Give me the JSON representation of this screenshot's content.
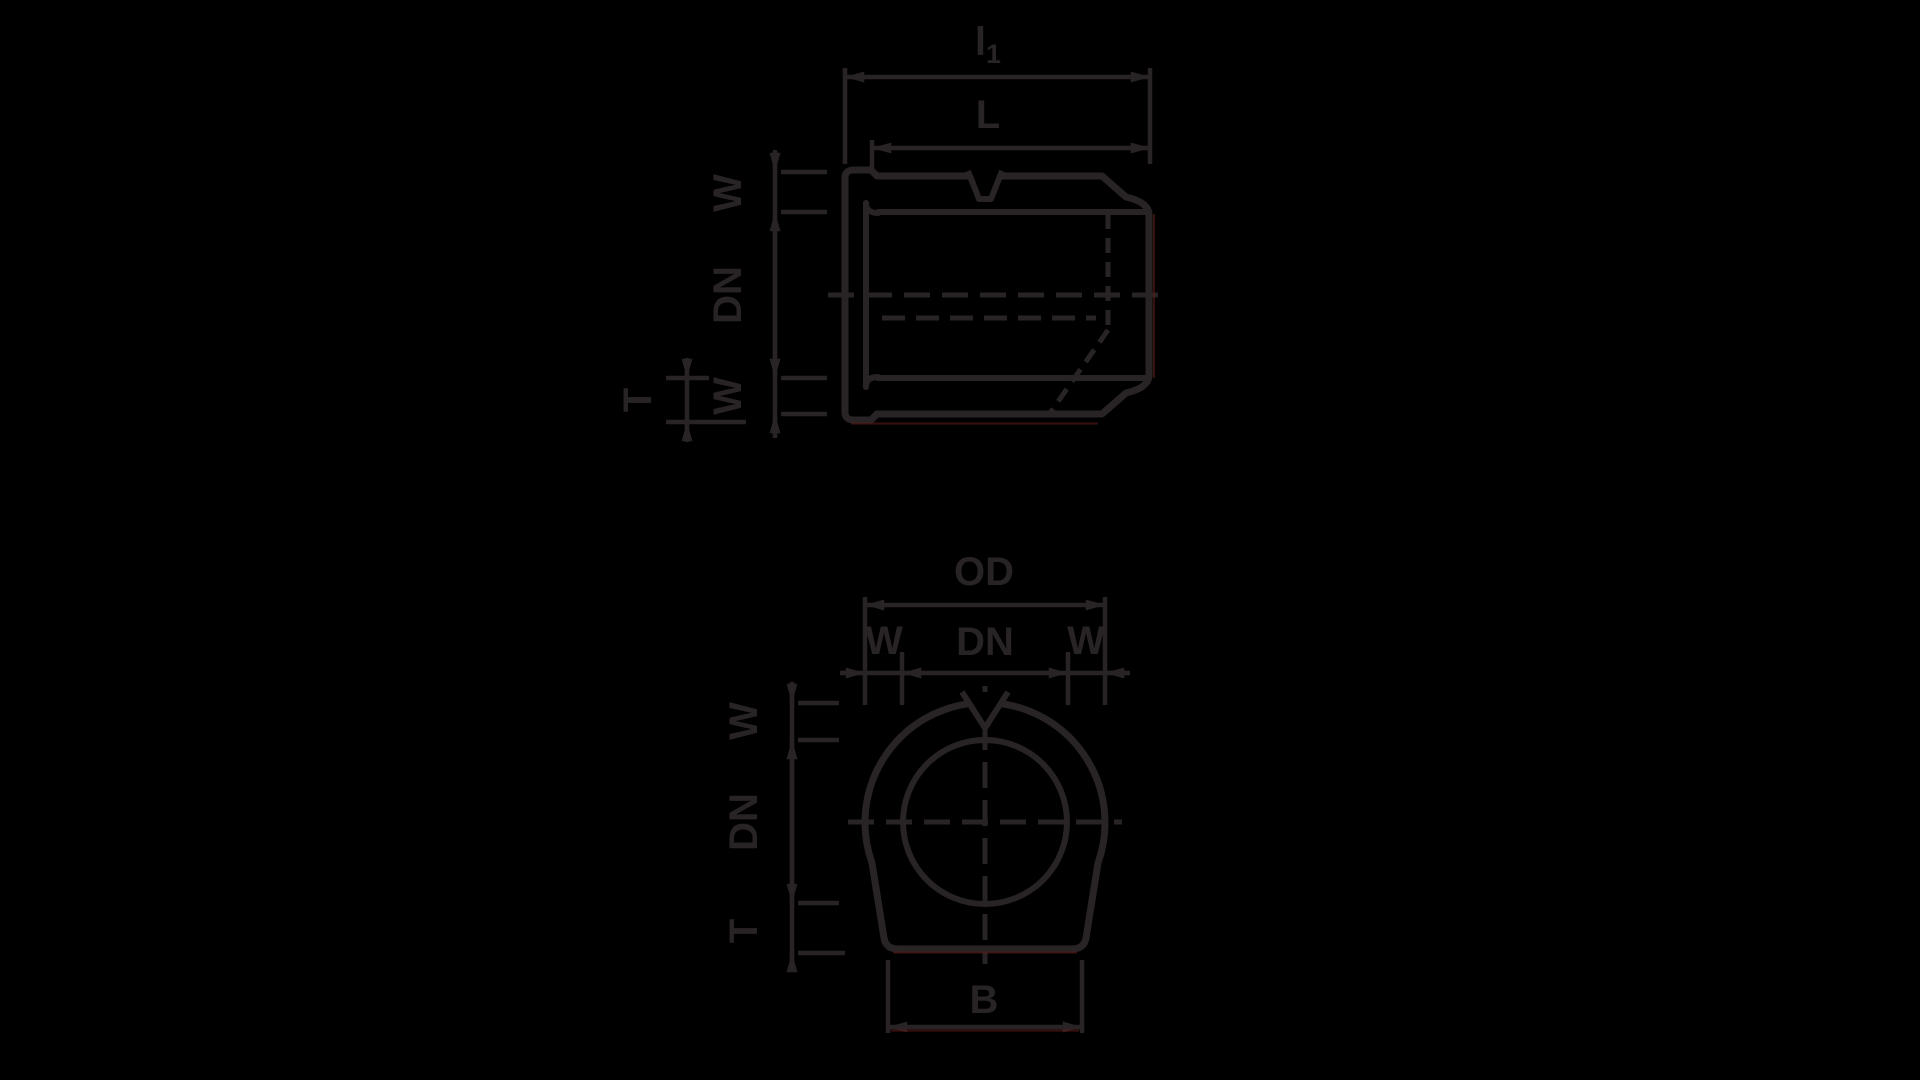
{
  "drawing": {
    "description": "Technical dimension drawing of a pipe coupling fitting, side cross-section view and front view",
    "colors": {
      "background": "#000000",
      "ink": "#282324",
      "fringe_red": "#5e1d1b"
    },
    "side_view": {
      "dims": {
        "overall_length": {
          "main": "l",
          "sub": "1"
        },
        "body_length": "L",
        "wall_top": "W",
        "bore": "DN",
        "wall_bottom": "W",
        "socket_wall": "T"
      }
    },
    "front_view": {
      "dims": {
        "outer_diameter": "OD",
        "wall_left": "W",
        "bore_top": "DN",
        "wall_right": "W",
        "wall_side": "W",
        "bore_side": "DN",
        "thickness_side": "T",
        "base_width": "B"
      }
    }
  }
}
